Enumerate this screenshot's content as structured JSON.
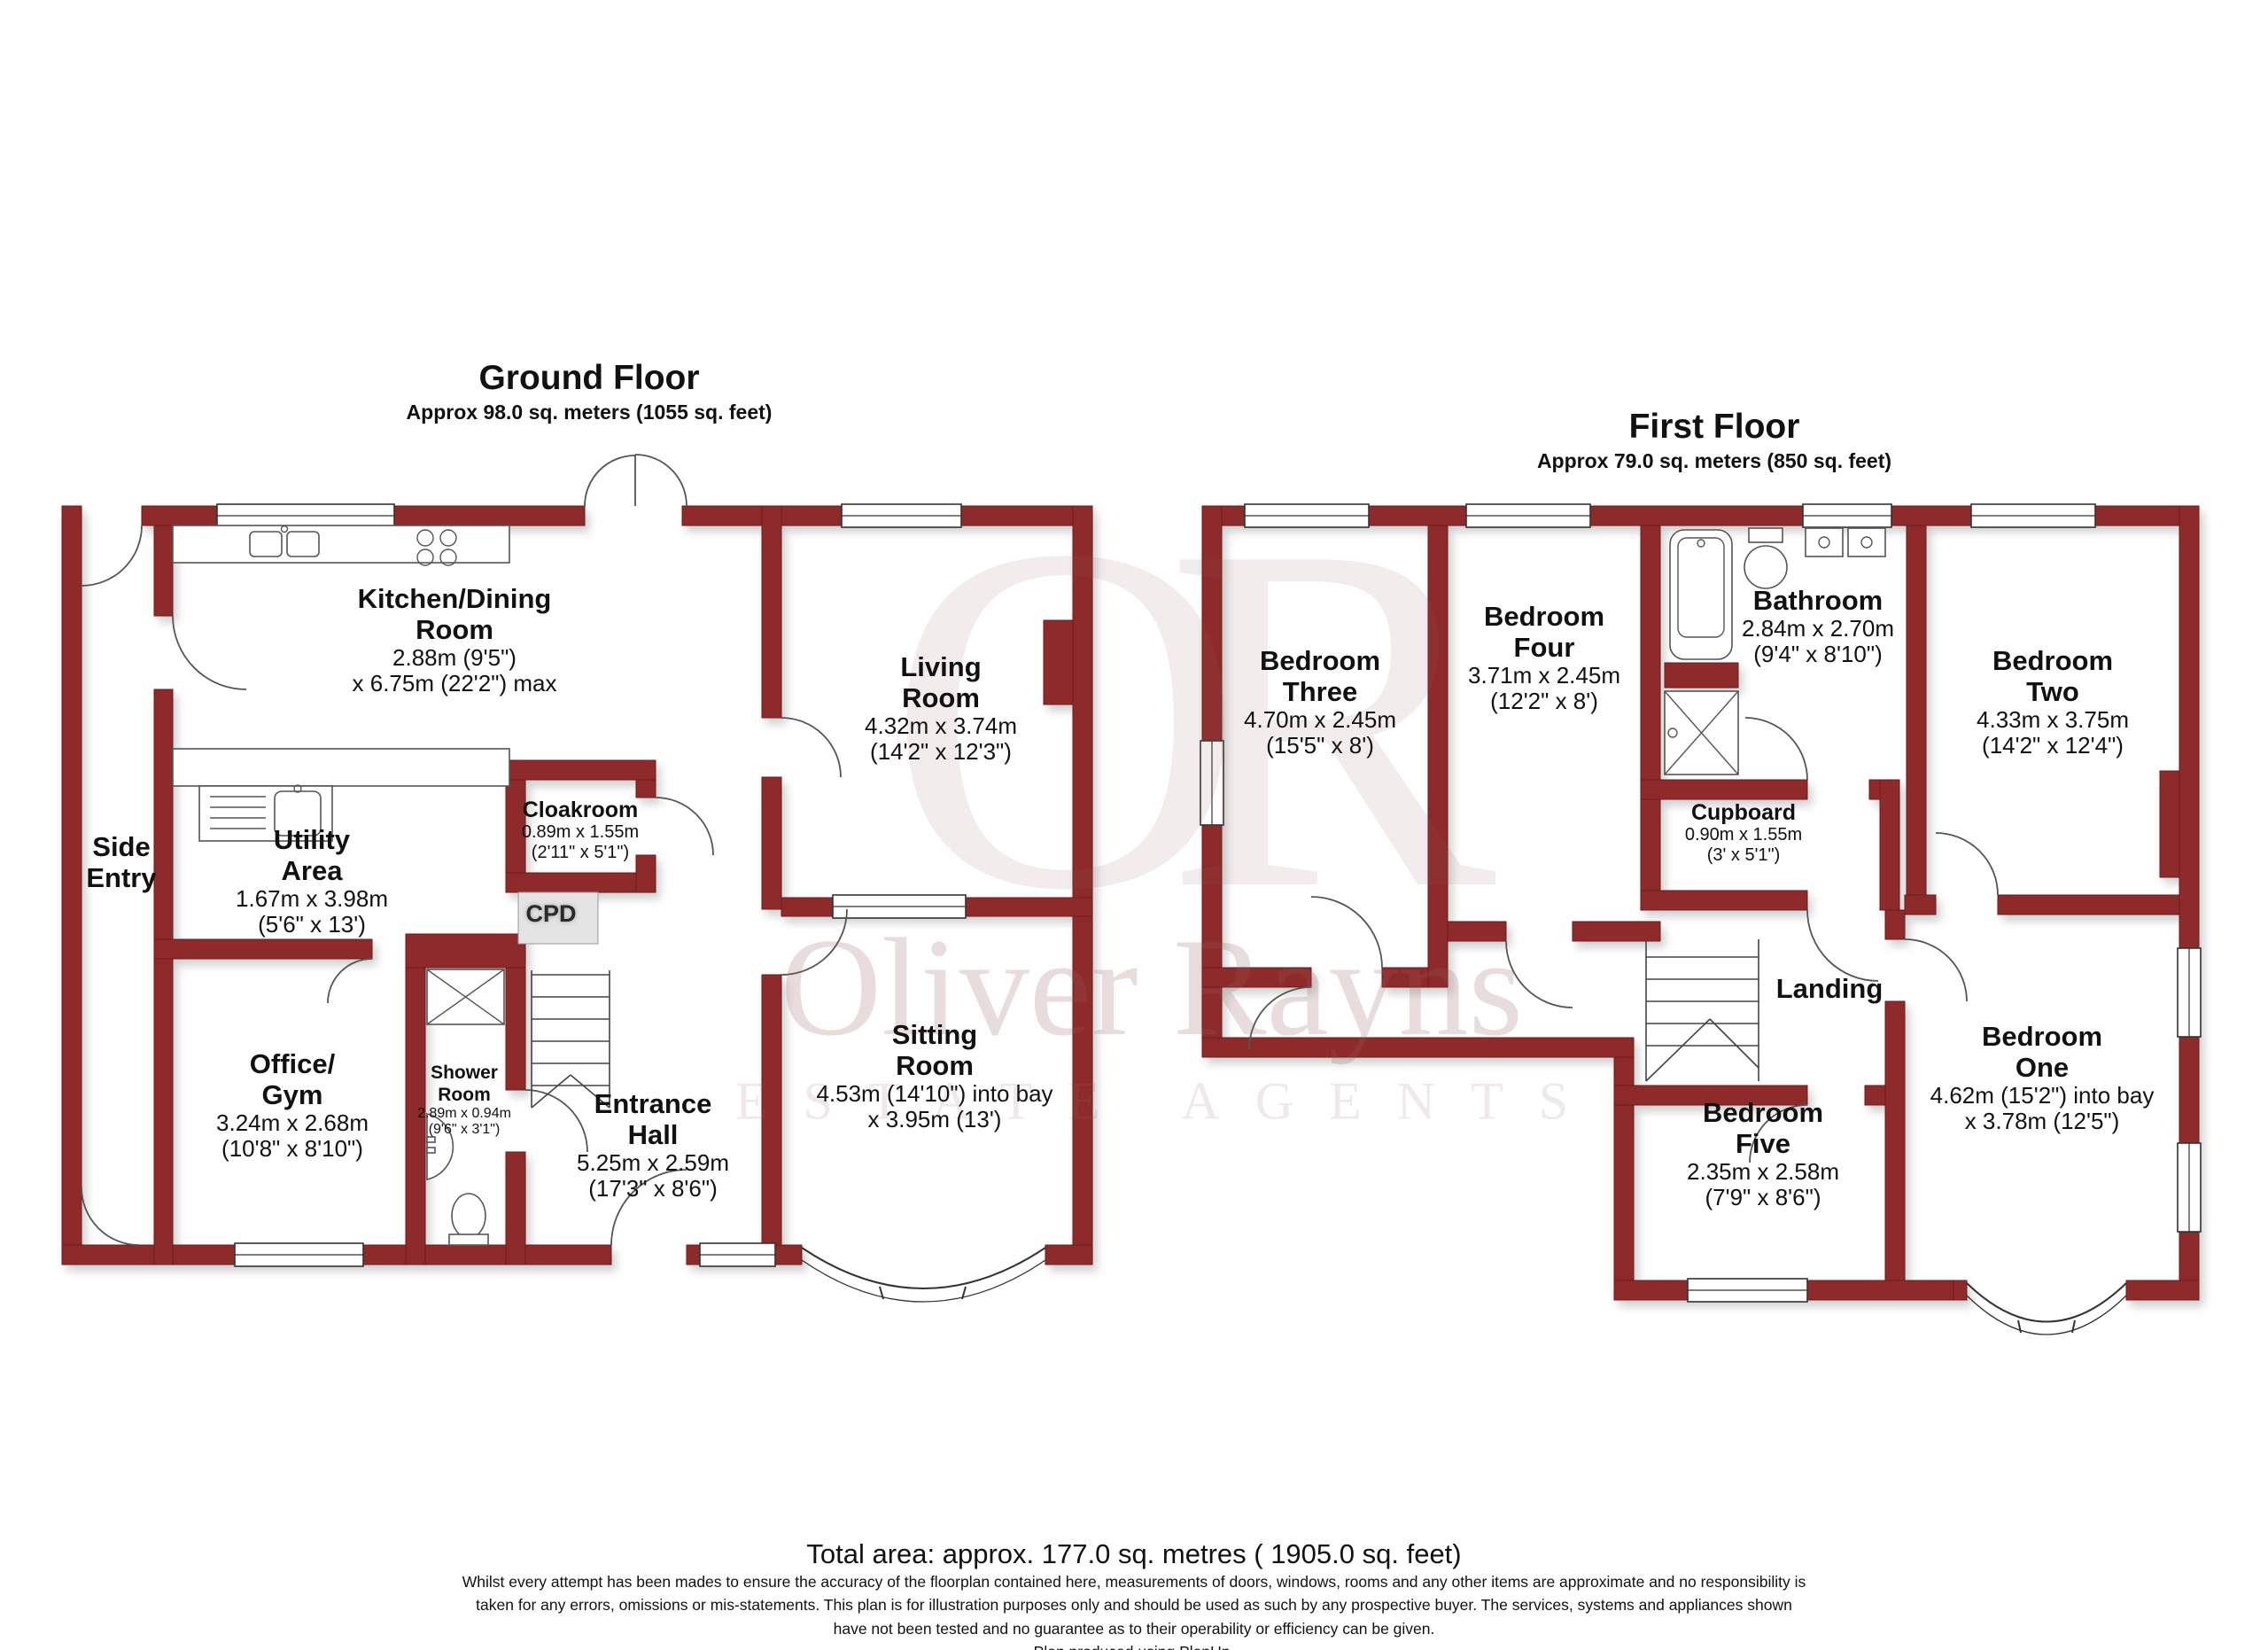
{
  "ground_floor": {
    "title": "Ground Floor",
    "subtitle": "Approx 98.0 sq. meters (1055 sq. feet)",
    "rooms": {
      "kitchen_dining": {
        "n1": "Kitchen/Dining",
        "n2": "Room",
        "d1": "2.88m (9'5\")",
        "d2": "x 6.75m (22'2\") max"
      },
      "living": {
        "n1": "Living",
        "n2": "Room",
        "d1": "4.32m x 3.74m",
        "d2": "(14'2\" x 12'3\")"
      },
      "cloakroom": {
        "n1": "Cloakroom",
        "d1": "0.89m x 1.55m",
        "d2": "(2'11\" x 5'1\")"
      },
      "side_entry": {
        "n1": "Side",
        "n2": "Entry"
      },
      "utility": {
        "n1": "Utility",
        "n2": "Area",
        "d1": "1.67m x 3.98m",
        "d2": "(5'6\" x 13')"
      },
      "cpd": {
        "label": "CPD"
      },
      "office_gym": {
        "n1": "Office/",
        "n2": "Gym",
        "d1": "3.24m x 2.68m",
        "d2": "(10'8\" x 8'10\")"
      },
      "shower_room": {
        "n1": "Shower",
        "n2": "Room",
        "d1": "2.89m x 0.94m",
        "d2": "(9'6\" x 3'1\")"
      },
      "entrance_hall": {
        "n1": "Entrance",
        "n2": "Hall",
        "d1": "5.25m x 2.59m",
        "d2": "(17'3\" x 8'6\")"
      },
      "sitting": {
        "n1": "Sitting",
        "n2": "Room",
        "d1": "4.53m (14'10\") into bay",
        "d2": "x 3.95m (13')"
      }
    }
  },
  "first_floor": {
    "title": "First Floor",
    "subtitle": "Approx 79.0 sq. meters (850 sq. feet)",
    "rooms": {
      "bedroom_three": {
        "n1": "Bedroom",
        "n2": "Three",
        "d1": "4.70m x 2.45m",
        "d2": "(15'5\" x 8')"
      },
      "bedroom_four": {
        "n1": "Bedroom",
        "n2": "Four",
        "d1": "3.71m x 2.45m",
        "d2": "(12'2\" x 8')"
      },
      "bathroom": {
        "n1": "Bathroom",
        "d1": "2.84m x 2.70m",
        "d2": "(9'4\" x 8'10\")"
      },
      "bedroom_two": {
        "n1": "Bedroom",
        "n2": "Two",
        "d1": "4.33m x 3.75m",
        "d2": "(14'2\" x 12'4\")"
      },
      "cupboard": {
        "n1": "Cupboard",
        "d1": "0.90m x 1.55m",
        "d2": "(3' x 5'1\")"
      },
      "landing": {
        "n1": "Landing"
      },
      "bedroom_five": {
        "n1": "Bedroom",
        "n2": "Five",
        "d1": "2.35m x 2.58m",
        "d2": "(7'9\" x 8'6\")"
      },
      "bedroom_one": {
        "n1": "Bedroom",
        "n2": "One",
        "d1": "4.62m (15'2\") into bay",
        "d2": "x 3.78m (12'5\")"
      }
    }
  },
  "watermark": {
    "monogram": "OR",
    "name": "Oliver Rayns",
    "tagline": "ESTATE AGENTS"
  },
  "footer": {
    "total_area": "Total area: approx. 177.0 sq. metres ( 1905.0 sq. feet)",
    "disclaimer": [
      "Whilst every attempt has been mades to ensure the accuracy of the floorplan contained here, measurements of doors, windows, rooms and any other items are approximate and no responsibility is",
      "taken for any errors, omissions or mis-statements.  This plan is for illustration purposes only and should be used as such by any prospective buyer. The services, systems and appliances shown",
      "have not been tested and no guarantee as to their operability or efficiency can be given.",
      "Plan produced using PlanUp."
    ]
  },
  "colors": {
    "wall": "#8e2b2b",
    "wall_edge": "#6a1d1d",
    "watermark": "#986060"
  }
}
